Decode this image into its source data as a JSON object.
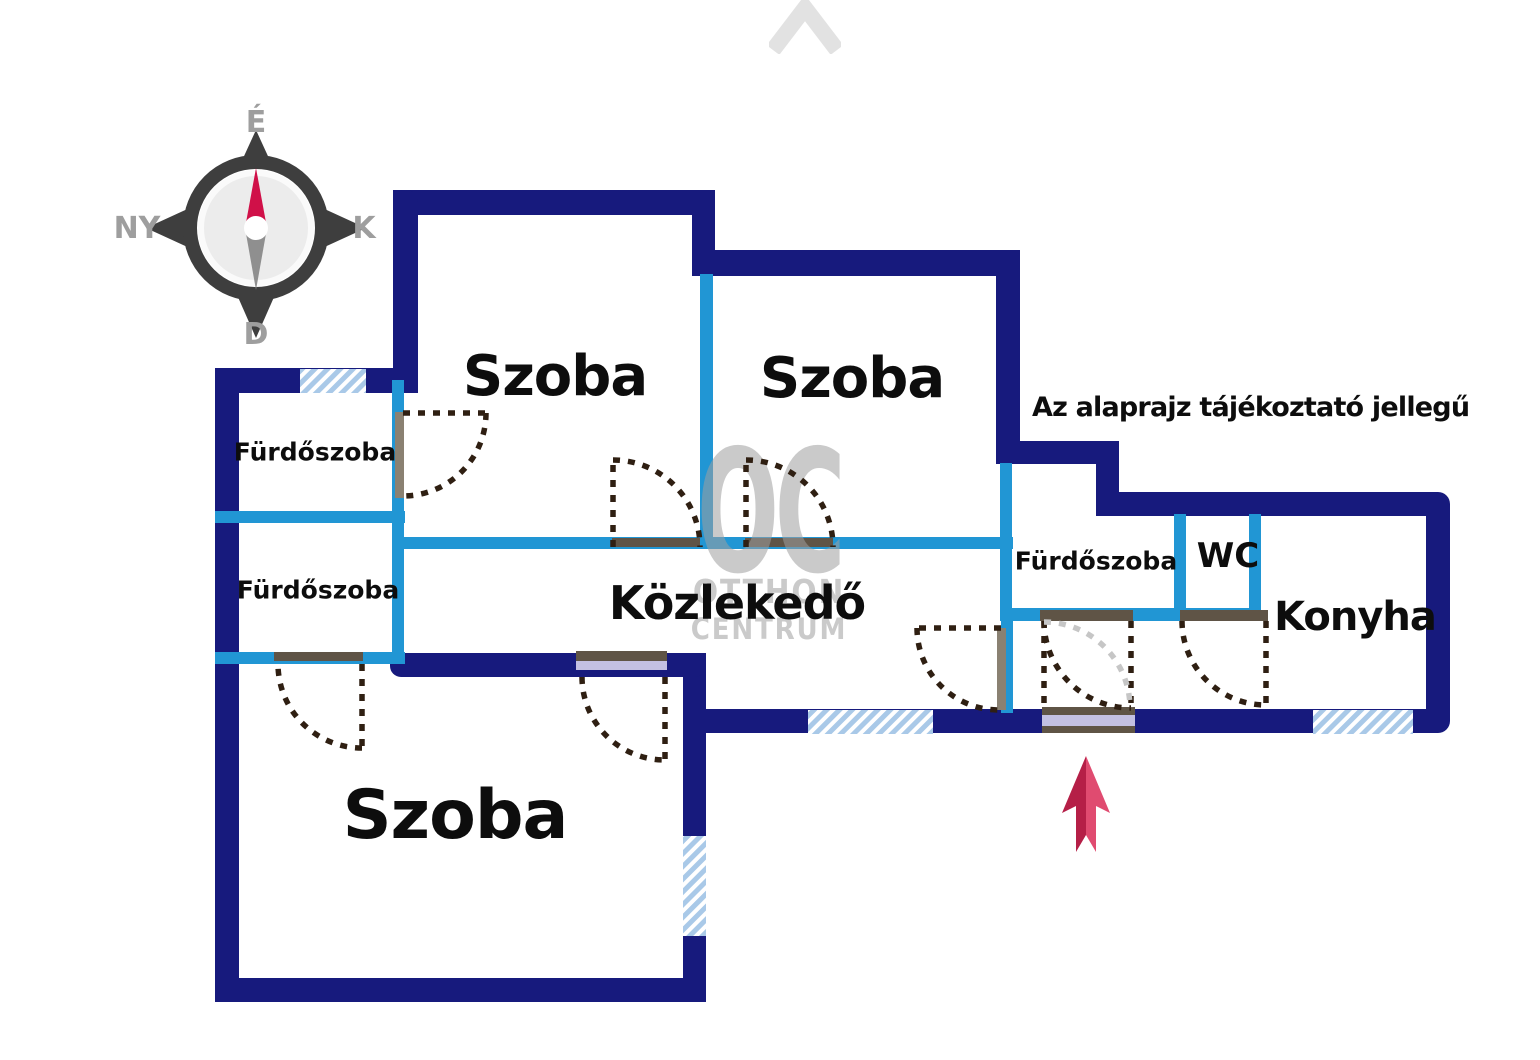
{
  "disclaimer": "Az alaprajz tájékoztató jellegű",
  "rooms": [
    {
      "id": "szoba-top-left",
      "label": "Szoba"
    },
    {
      "id": "szoba-top-right",
      "label": "Szoba"
    },
    {
      "id": "szoba-bottom",
      "label": "Szoba"
    },
    {
      "id": "furdoszoba-upper-left",
      "label": "Fürdőszoba"
    },
    {
      "id": "furdoszoba-lower-left",
      "label": "Fürdőszoba"
    },
    {
      "id": "furdoszoba-right",
      "label": "Fürdőszoba"
    },
    {
      "id": "wc",
      "label": "WC"
    },
    {
      "id": "konyha",
      "label": "Konyha"
    },
    {
      "id": "kozlekedo",
      "label": "Közlekedő"
    }
  ],
  "compass": {
    "north_label": "É",
    "west_label": "NY",
    "east_label": "K",
    "south_label": "D"
  },
  "watermark": {
    "monogram": "OC",
    "word1": "OTTHON",
    "word2": "CENTRUM"
  },
  "colors": {
    "wall_exterior": "#171a7d",
    "wall_interior": "#2196d4",
    "window_fill": "#a9c9e8",
    "door_arc": "#2f1f12",
    "door_arc_alt": "#c6c6c6",
    "lintel_dark": "#5f5446",
    "lintel_gray": "#8a8172",
    "door_panel": "#c3c0e2",
    "arrow_dark": "#b51f47",
    "arrow_light": "#e04b70",
    "compass_body": "#3e3e3e",
    "compass_needle_north": "#d01048",
    "compass_needle_south": "#8f8f8f",
    "compass_text": "#9e9e9e",
    "watermark_gray": "#a0a0a0"
  }
}
